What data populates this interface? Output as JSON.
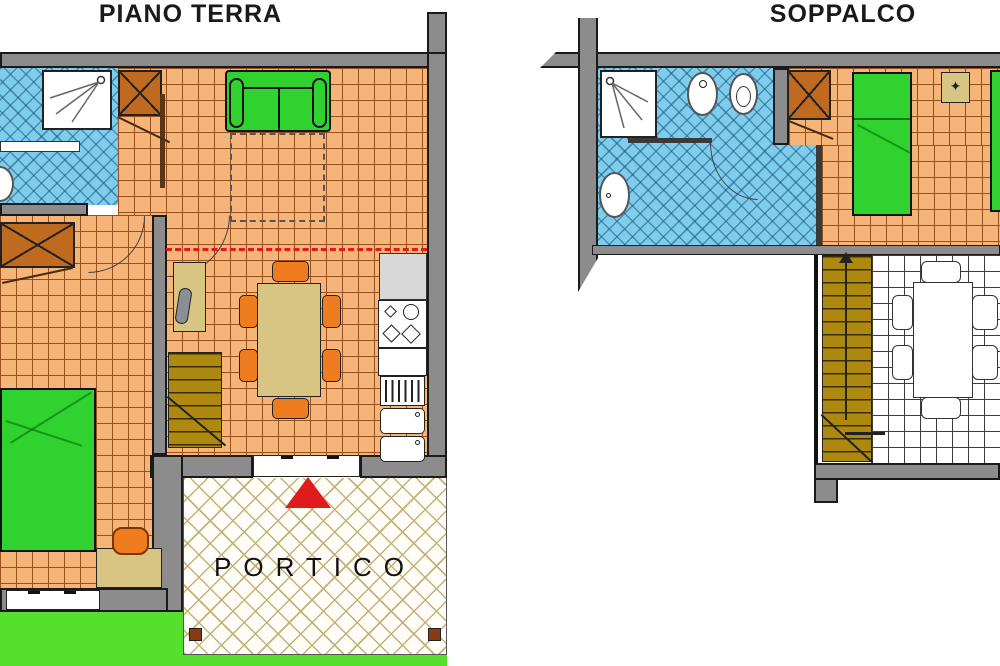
{
  "titles": {
    "left": "PIANO TERRA",
    "right": "SOPPALCO"
  },
  "labels": {
    "portico": "PORTICO"
  },
  "icons": {
    "flower": "✦"
  },
  "colors": {
    "wall": "#8c8c8c",
    "wall_outline": "#1a1a1a",
    "floor_tile": "#f5b578",
    "floor_grid": "#9a4f1e",
    "bath_tile": "#7fcdec",
    "furniture_green": "#2fd22f",
    "wood_brown": "#bf6a1f",
    "stair_gold": "#ad8a0f",
    "chair_orange": "#ef7d1f",
    "table_tan": "#d9c583",
    "entrance_red": "#e01b1b",
    "portico_grid": "#c5b077",
    "grass_green": "#55e02e"
  }
}
